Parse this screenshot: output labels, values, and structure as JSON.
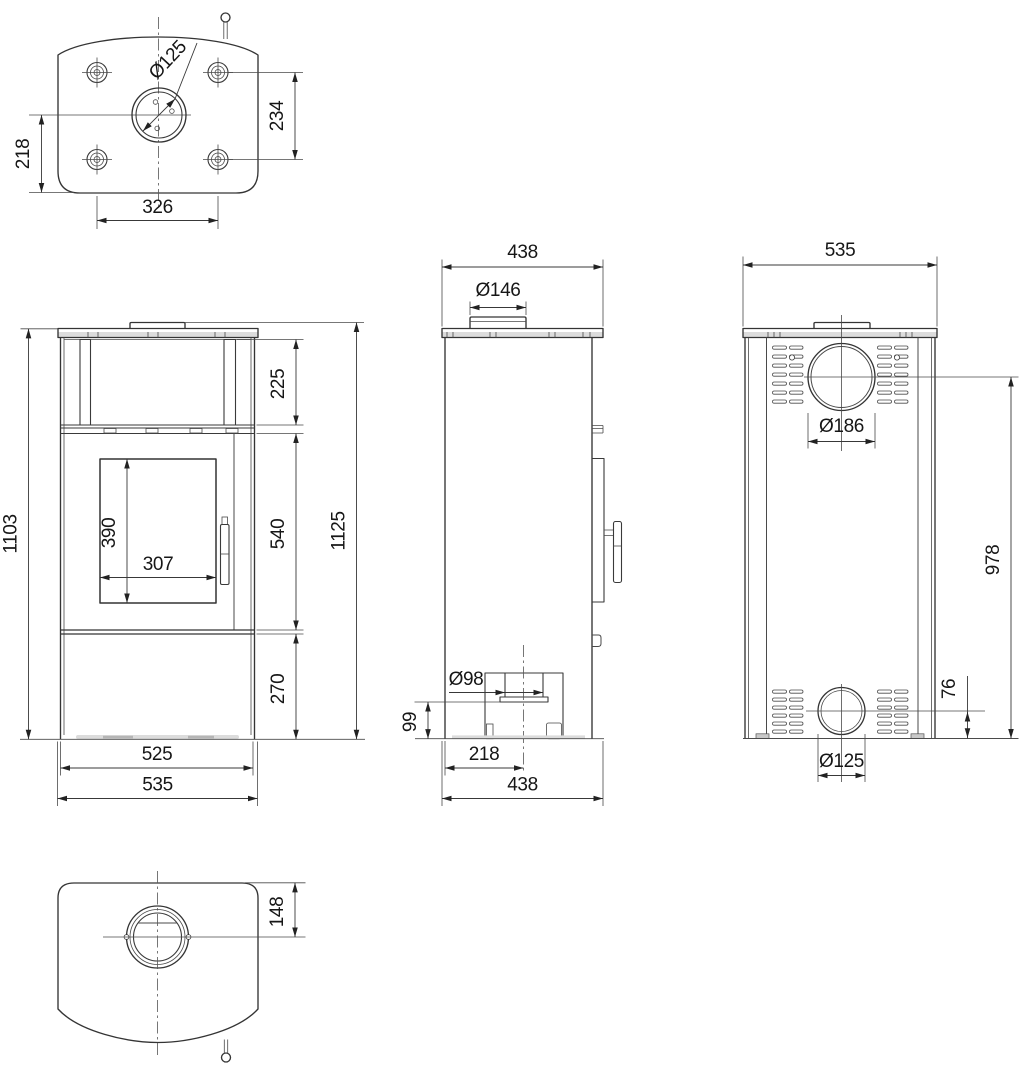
{
  "drawing": {
    "background": "#ffffff",
    "line_color": "#343434",
    "views": {
      "top": {
        "dims": {
          "flue_diameter": "Ø125",
          "rear_offset": "218",
          "bolt_row_spacing": "234",
          "bolt_col_spacing": "326"
        }
      },
      "front": {
        "dims": {
          "body_height": "1103",
          "niche_height": "225",
          "glass_height": "390",
          "glass_width": "307",
          "door_section_height": "540",
          "base_height": "270",
          "total_height": "1125",
          "plinth_width": "525",
          "total_width": "535"
        }
      },
      "side": {
        "dims": {
          "depth_top": "438",
          "collar_diameter": "Ø146",
          "inlet_diameter": "Ø98",
          "inlet_bottom_height": "99",
          "inlet_center_offset": "218",
          "depth_bottom": "438"
        }
      },
      "back": {
        "dims": {
          "total_width": "535",
          "flue_diameter": "Ø186",
          "flue_center_height": "978",
          "inlet_center_height": "76",
          "inlet_diameter": "Ø125"
        }
      },
      "bottom": {
        "dims": {
          "inlet_center_offset": "148"
        }
      }
    }
  }
}
